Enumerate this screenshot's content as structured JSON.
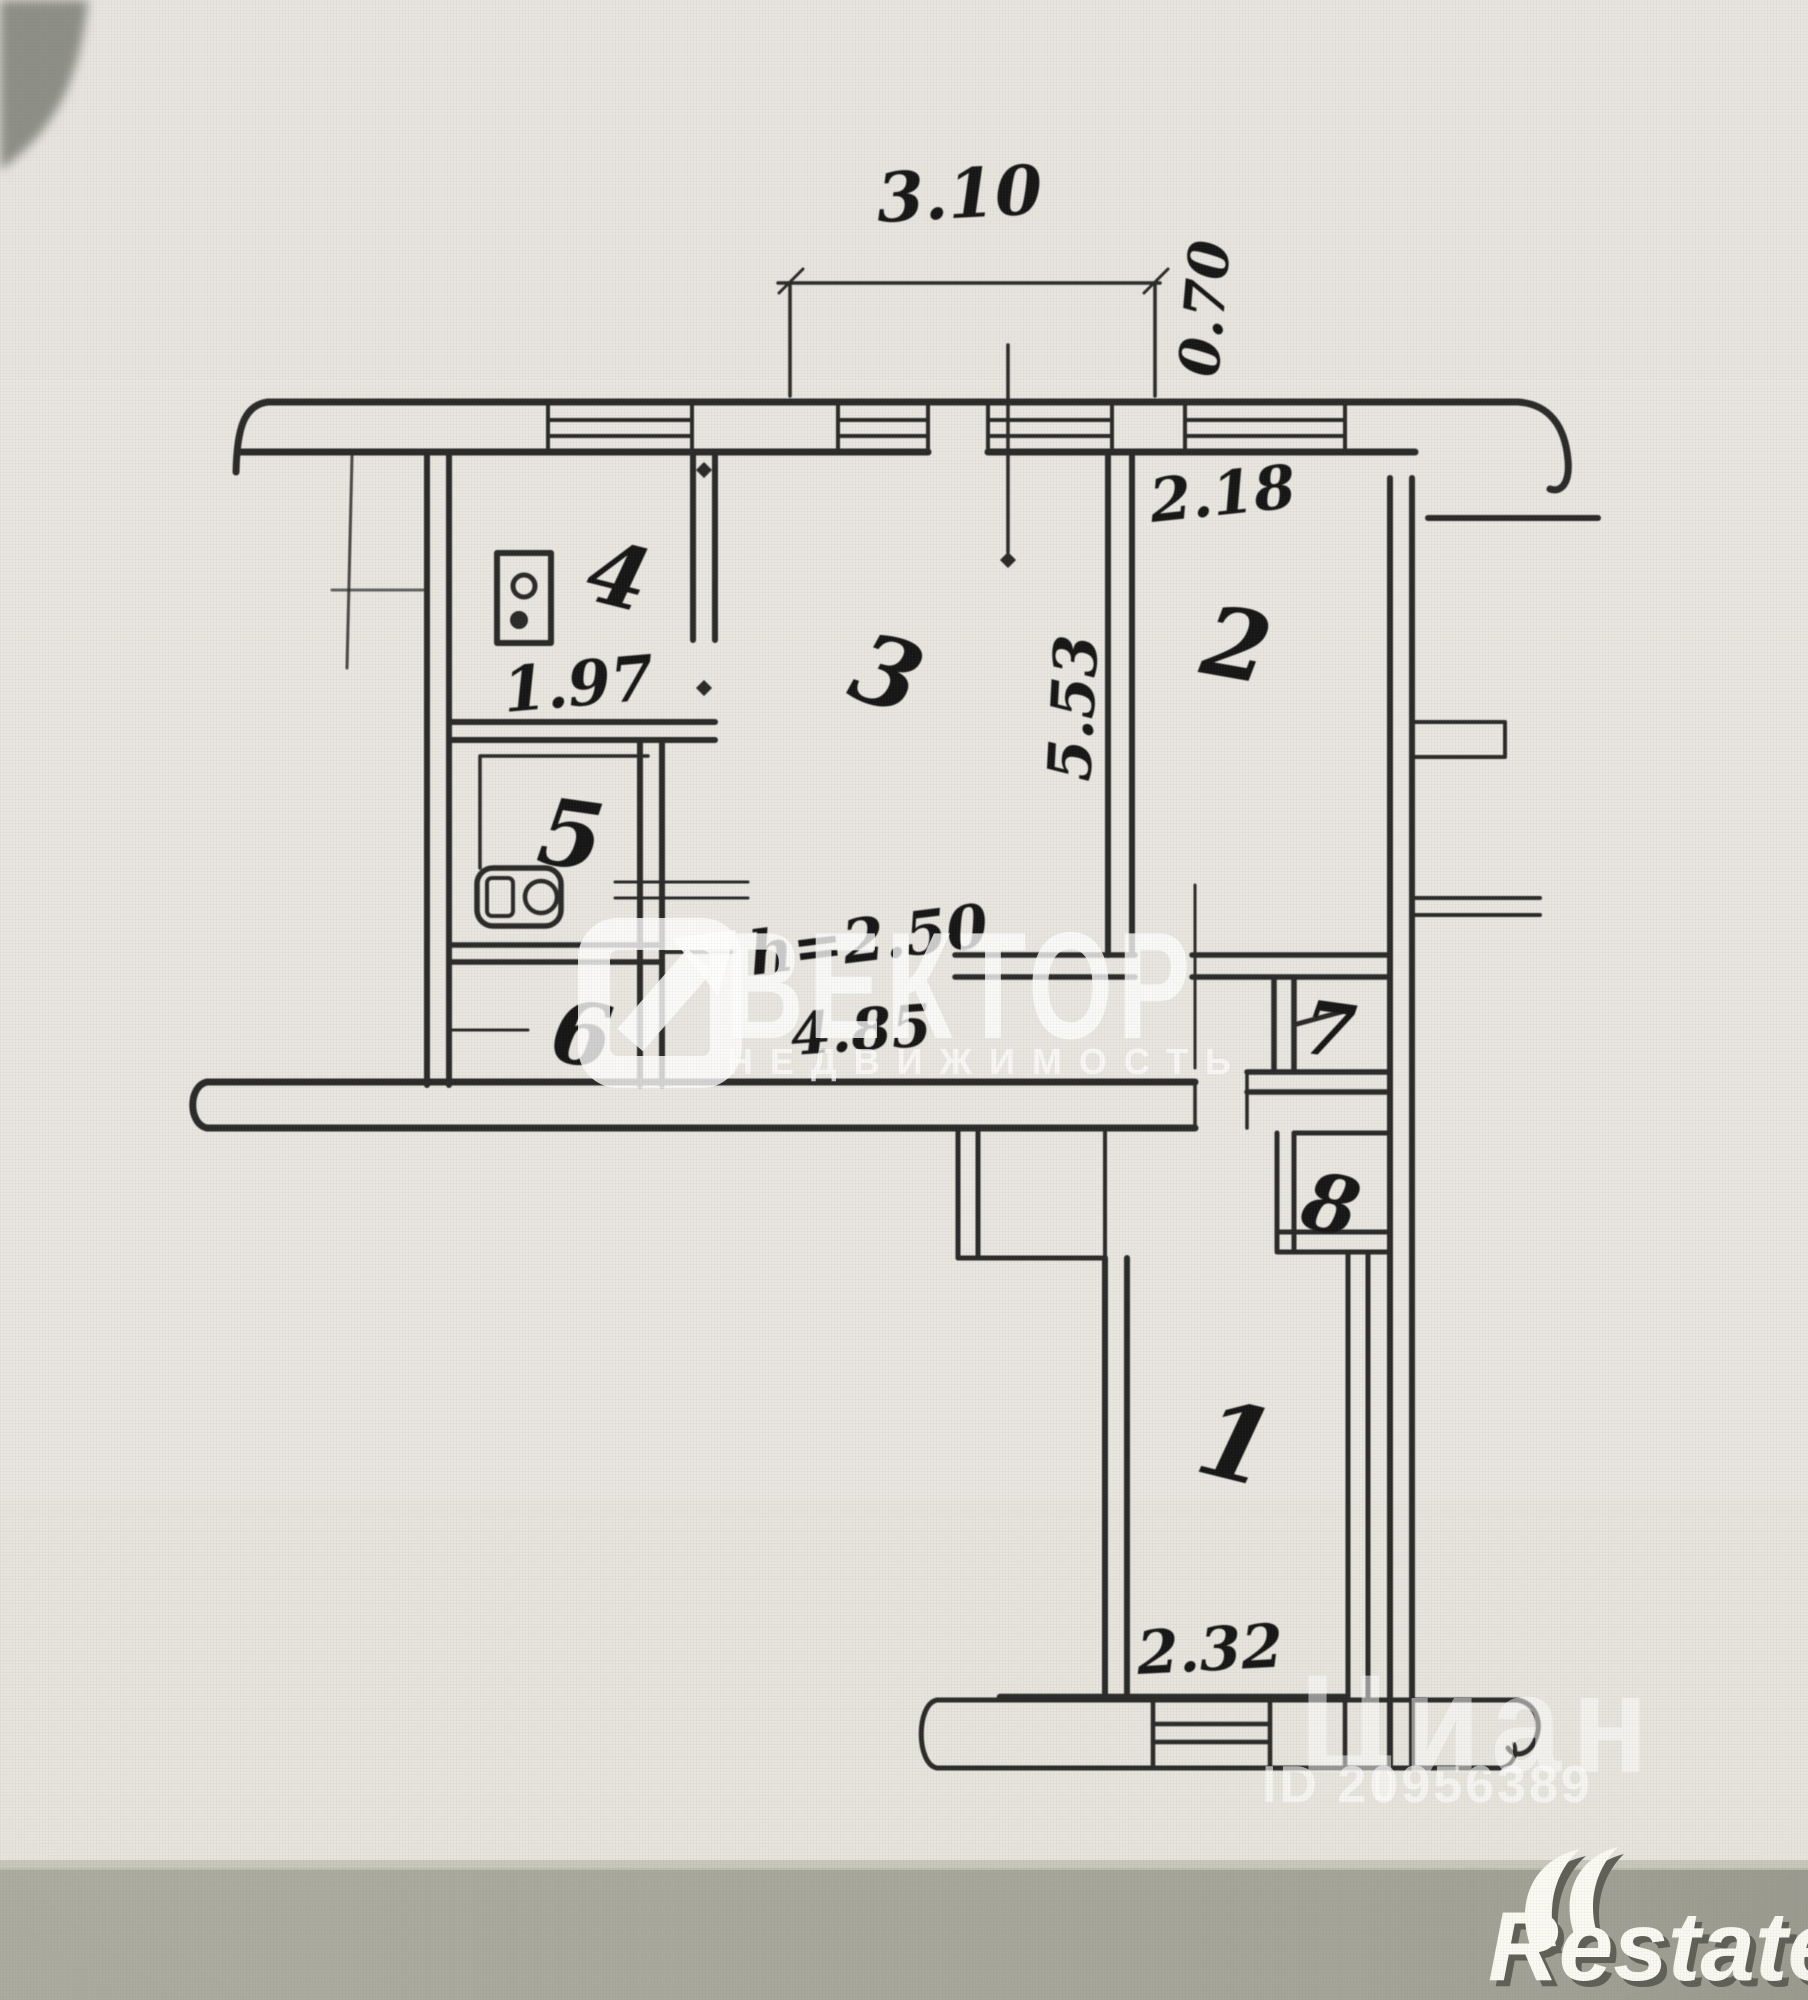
{
  "plan": {
    "room_labels": {
      "r1": "1",
      "r2": "2",
      "r3": "3",
      "r4": "4",
      "r5": "5",
      "r6": "6",
      "r7": "7",
      "r8": "8"
    },
    "dimensions": {
      "balcony_width": "3.10",
      "balcony_depth": "0.70",
      "kitchen_width": "1.97",
      "room2_width": "2.18",
      "room3_depth": "5.53",
      "ceiling_height": "h=2.50",
      "corridor_length": "4.85",
      "room1_width": "2.32"
    },
    "fixture_icons": [
      "stove-icon",
      "washbasin-icon",
      "toilet-icon"
    ]
  },
  "watermarks": {
    "vektor": {
      "logo": "arrow-square-icon",
      "title": "ВЕКТОР",
      "subtitle": "НЕДВИЖИМОСТЬ"
    },
    "cian": {
      "brand": "Циан",
      "listing_id": "ID 20956389"
    },
    "restate": {
      "brand": "Restate",
      "logo": "double-swoosh-icon"
    }
  },
  "colors": {
    "paper": "#e9e7e0",
    "ink": "#1c1c1c",
    "bottom_band": "#a8a89d",
    "corner_shadow": "#8e9087",
    "watermark": "#ffffff"
  }
}
